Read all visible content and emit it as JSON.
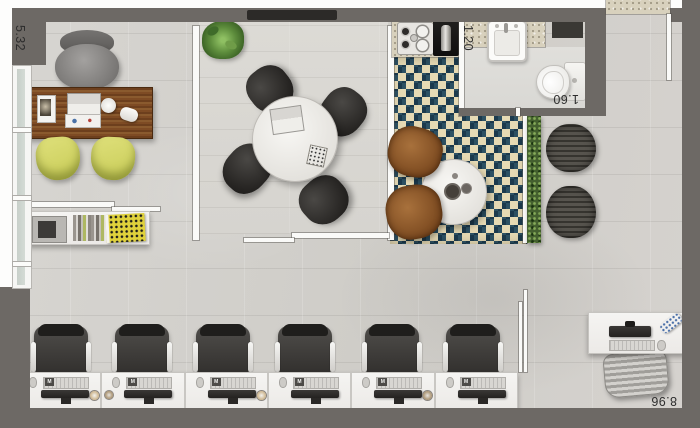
{
  "plan_title": "studio-office-floor-plan",
  "dimension_labels": {
    "left_wall": "5.32",
    "kitchen": "1.20",
    "bathroom": "1.60",
    "bottom_wall": "8.96"
  },
  "workstations": {
    "count": 6,
    "keyboard_logo": "M"
  },
  "areas": {
    "private_office": [
      "executive-desk",
      "executive-chair",
      "guest-chair",
      "guest-chair",
      "sideboard"
    ],
    "meeting_room": [
      "round-table",
      "meeting-chair",
      "meeting-chair",
      "meeting-chair",
      "meeting-chair",
      "plant",
      "tv"
    ],
    "kitchenette": [
      "counter",
      "cooktop",
      "coffee-cabinet",
      "patterned-rug",
      "lounge-chair",
      "lounge-chair",
      "coffee-table"
    ],
    "bathroom": [
      "counter",
      "sink",
      "toilet",
      "shelf"
    ],
    "lounge": [
      "hedge",
      "pouf",
      "pouf"
    ],
    "open_office": [
      "workstation-row",
      "task-chairs"
    ],
    "reception": [
      "reception-desk",
      "reception-chair",
      "monitor",
      "keyboard",
      "phone"
    ]
  },
  "colors": {
    "outer_wall": "#6d6965",
    "floor_concrete": "#d4d2ce",
    "rug_teal": "#2d5163",
    "rug_cream": "#e6dab4",
    "rug_navy": "#1c3a4d",
    "guest_chair_yellow": "#d5d867",
    "desk_wood": "#7a4a22",
    "hedge_green": "#44602f",
    "granite_counter": "#d8d1bd"
  }
}
